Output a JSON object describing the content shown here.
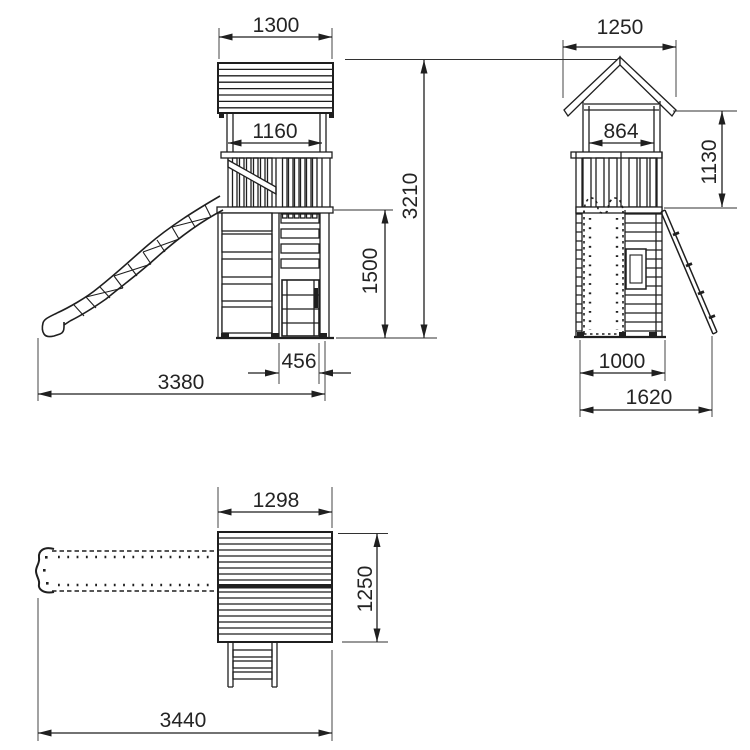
{
  "drawing": {
    "background": "#ffffff",
    "line_color": "#1f1f1f",
    "text_color": "#242424",
    "views": {
      "front": {
        "dims": {
          "roof_width": "1300",
          "frame_width": "1160",
          "total_height": "3210",
          "platform_height": "1500",
          "ladder_width": "456",
          "overall_width": "3380"
        }
      },
      "side": {
        "dims": {
          "roof_width": "1250",
          "inner_width": "864",
          "upper_height": "1130",
          "tower_depth": "1000",
          "overall_depth": "1620"
        }
      },
      "plan": {
        "dims": {
          "roof_width": "1298",
          "roof_depth": "1250",
          "overall_length": "3440"
        }
      }
    }
  }
}
